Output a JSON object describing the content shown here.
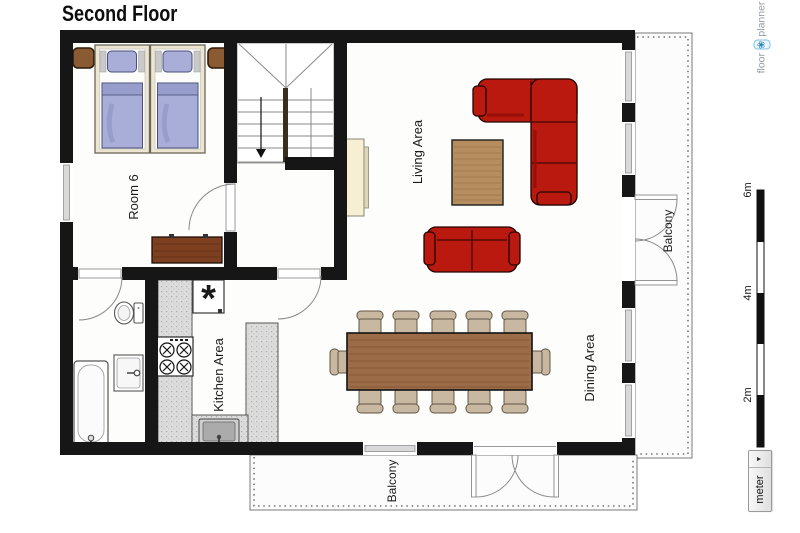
{
  "title": "Second Floor",
  "logo": {
    "prefix": "floor",
    "suffix": "planner",
    "icon_glyph": "❀"
  },
  "labels": {
    "room6": "Room 6",
    "living": "Living Area",
    "dining": "Dining Area",
    "kitchen": "Kitchen Area",
    "balcony_right": "Balcony",
    "balcony_bottom": "Balcony"
  },
  "scale": {
    "unit": "meter",
    "arrow": "▼",
    "ticks": [
      "6m",
      "4m",
      "2m"
    ]
  },
  "symbols": {
    "fridge": "*"
  },
  "colors": {
    "wall": "#161616",
    "floor": "#fdfdfc",
    "balcony": "#fcfcfc",
    "sofa_red": "#b9190f",
    "wood_dining": "#9c6b47",
    "wood_coffee": "#b68d5f",
    "chair_tan": "#c8b8a2",
    "bed_linen": "#a9aed8",
    "bed_frame": "#ece5cf",
    "nightstand_brown": "#8a5a33",
    "dresser_brown": "#7c3f20",
    "counter_gray": "#dcdcdc",
    "fireplace_cream": "#f6efd3"
  }
}
